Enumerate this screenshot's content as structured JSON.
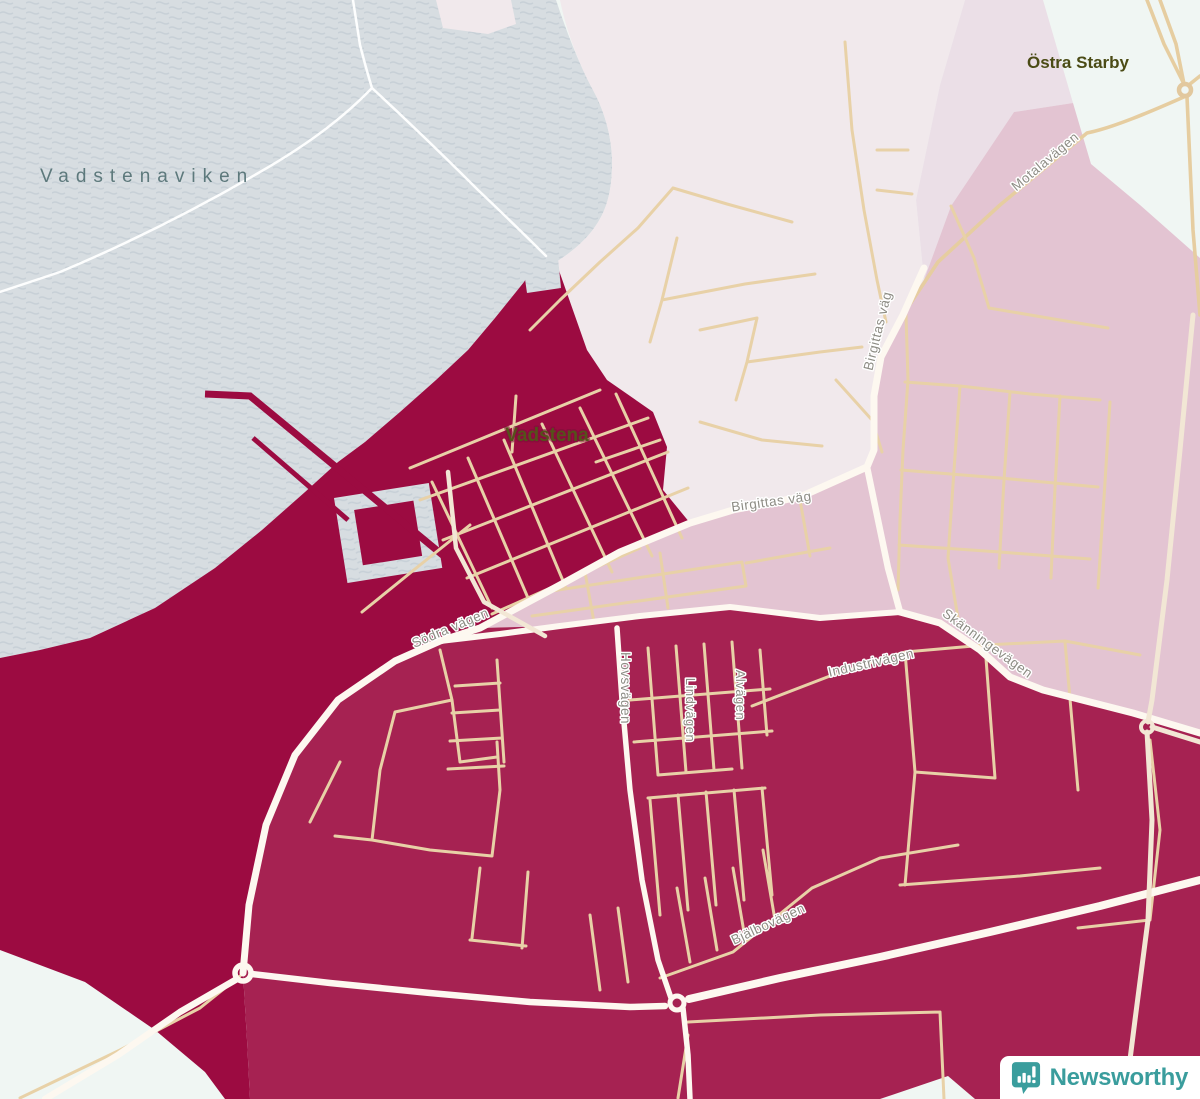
{
  "map": {
    "labels": {
      "water": "Vadstenaviken",
      "district": "Östra Starby",
      "city": "Vadstena"
    },
    "roads": {
      "motalavagen": "Motalavägen",
      "birgittas_vag_upper": "Birgittas väg",
      "birgittas_vag_lower": "Birgittas väg",
      "sodra_vagen": "Södra vägen",
      "hovsvagen": "Hovsvägen",
      "lindvagen": "Lindvägen",
      "alvagen": "Alvägen",
      "industrivagen": "Industrivägen",
      "bjalbovagen": "Bjälbovägen",
      "skanningevagen": "Skänningevägen"
    },
    "colors": {
      "region_darkest": "#9c0b41",
      "region_dark": "#a62252",
      "region_medium": "#e3c4d2",
      "region_light": "#f1e9ec",
      "region_light_alt": "#ebdfe7",
      "water": "#d7dde1",
      "land_base": "#f0f6f3",
      "road_minor": "#e8d1a7",
      "road_major": "#fdf8f0",
      "brand_teal": "#3a9d9d"
    }
  },
  "logo": {
    "text": "Newsworthy",
    "icon": "newsworthy-chart-bubble-icon"
  }
}
